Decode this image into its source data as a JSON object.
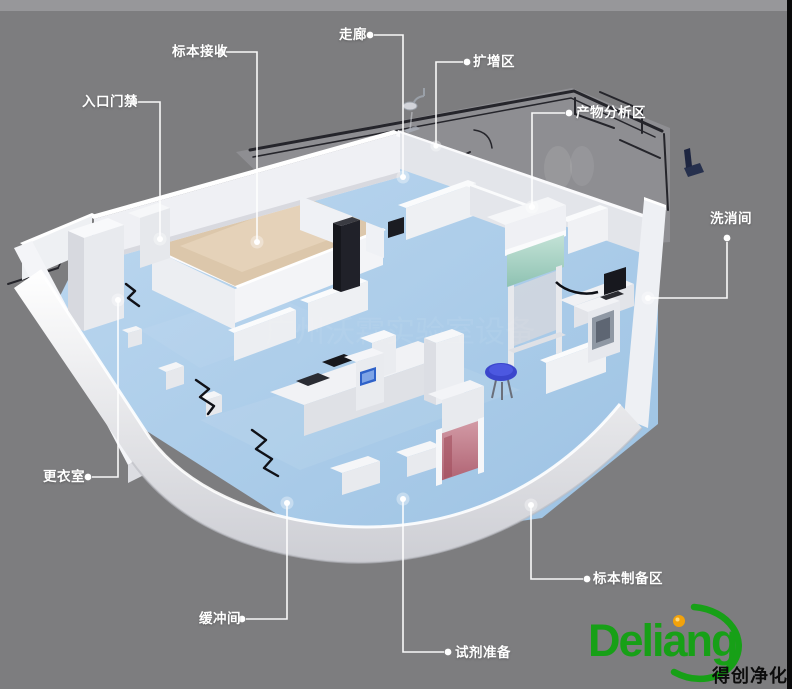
{
  "diagram_title_implicit": "PCR实验室三维布局图",
  "labels": {
    "specimen_reception": "标本接收",
    "entrance_access": "入口门禁",
    "corridor": "走廊",
    "amplification_area": "扩增区",
    "product_analysis_area": "产物分析区",
    "washing_room": "洗消间",
    "changing_room": "更衣室",
    "buffer_room": "缓冲间",
    "reagent_preparation": "试剂准备",
    "specimen_preparation_area": "标本制备区"
  },
  "watermark": "广州沃霖实验室设备",
  "logo": {
    "brand": "Deliang",
    "tagline": "得创净化",
    "green": "#17a017",
    "orange": "#f2a20a"
  },
  "palette": {
    "background": "#7d7d7f",
    "top_band": "#97979a",
    "right_edge_strip": "#0a0a0b",
    "floor_blue": "#a6c9e8",
    "floor_beige": "#dcc7ab",
    "wall_white": "#f2f2f5",
    "cabinet_glass_teal": "#aed2c6",
    "fume_hood_pink": "#c4848e",
    "stool_blue": "#3c47cf",
    "blueprint_line": "#25252b",
    "callout_white": "#ffffff"
  }
}
